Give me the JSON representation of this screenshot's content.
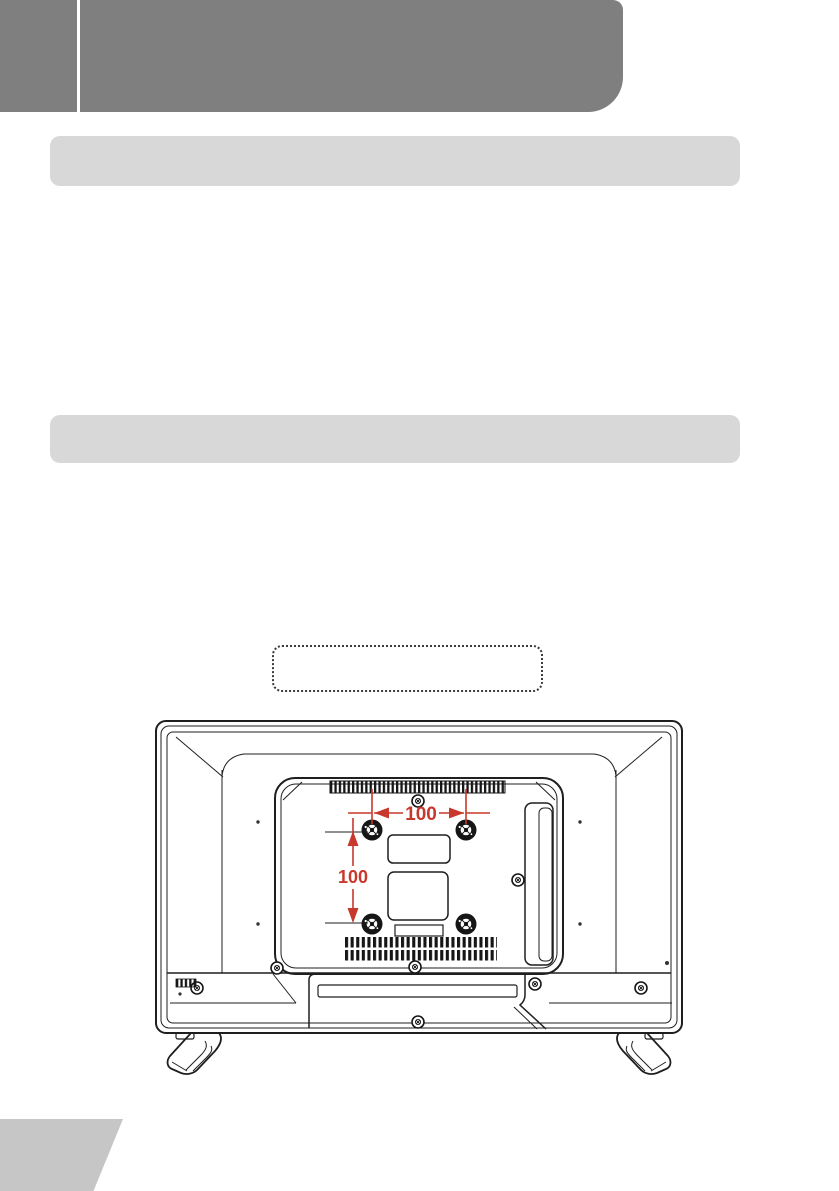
{
  "document": {
    "kind": "tv-user-manual-page",
    "header_banner": {
      "color": "#7f7f7f",
      "divider_color": "#ffffff"
    },
    "section_header_count": 2,
    "section_header_color": "#d8d8d8",
    "footer_corner_color": "#c6c6c6"
  },
  "diagram": {
    "subject": "tv-rear-view",
    "line_color": "#1f1f1f",
    "wall_mount": {
      "hole_spacing_horizontal": "100",
      "hole_spacing_vertical": "100",
      "dimension_color": "#c8382d"
    }
  }
}
